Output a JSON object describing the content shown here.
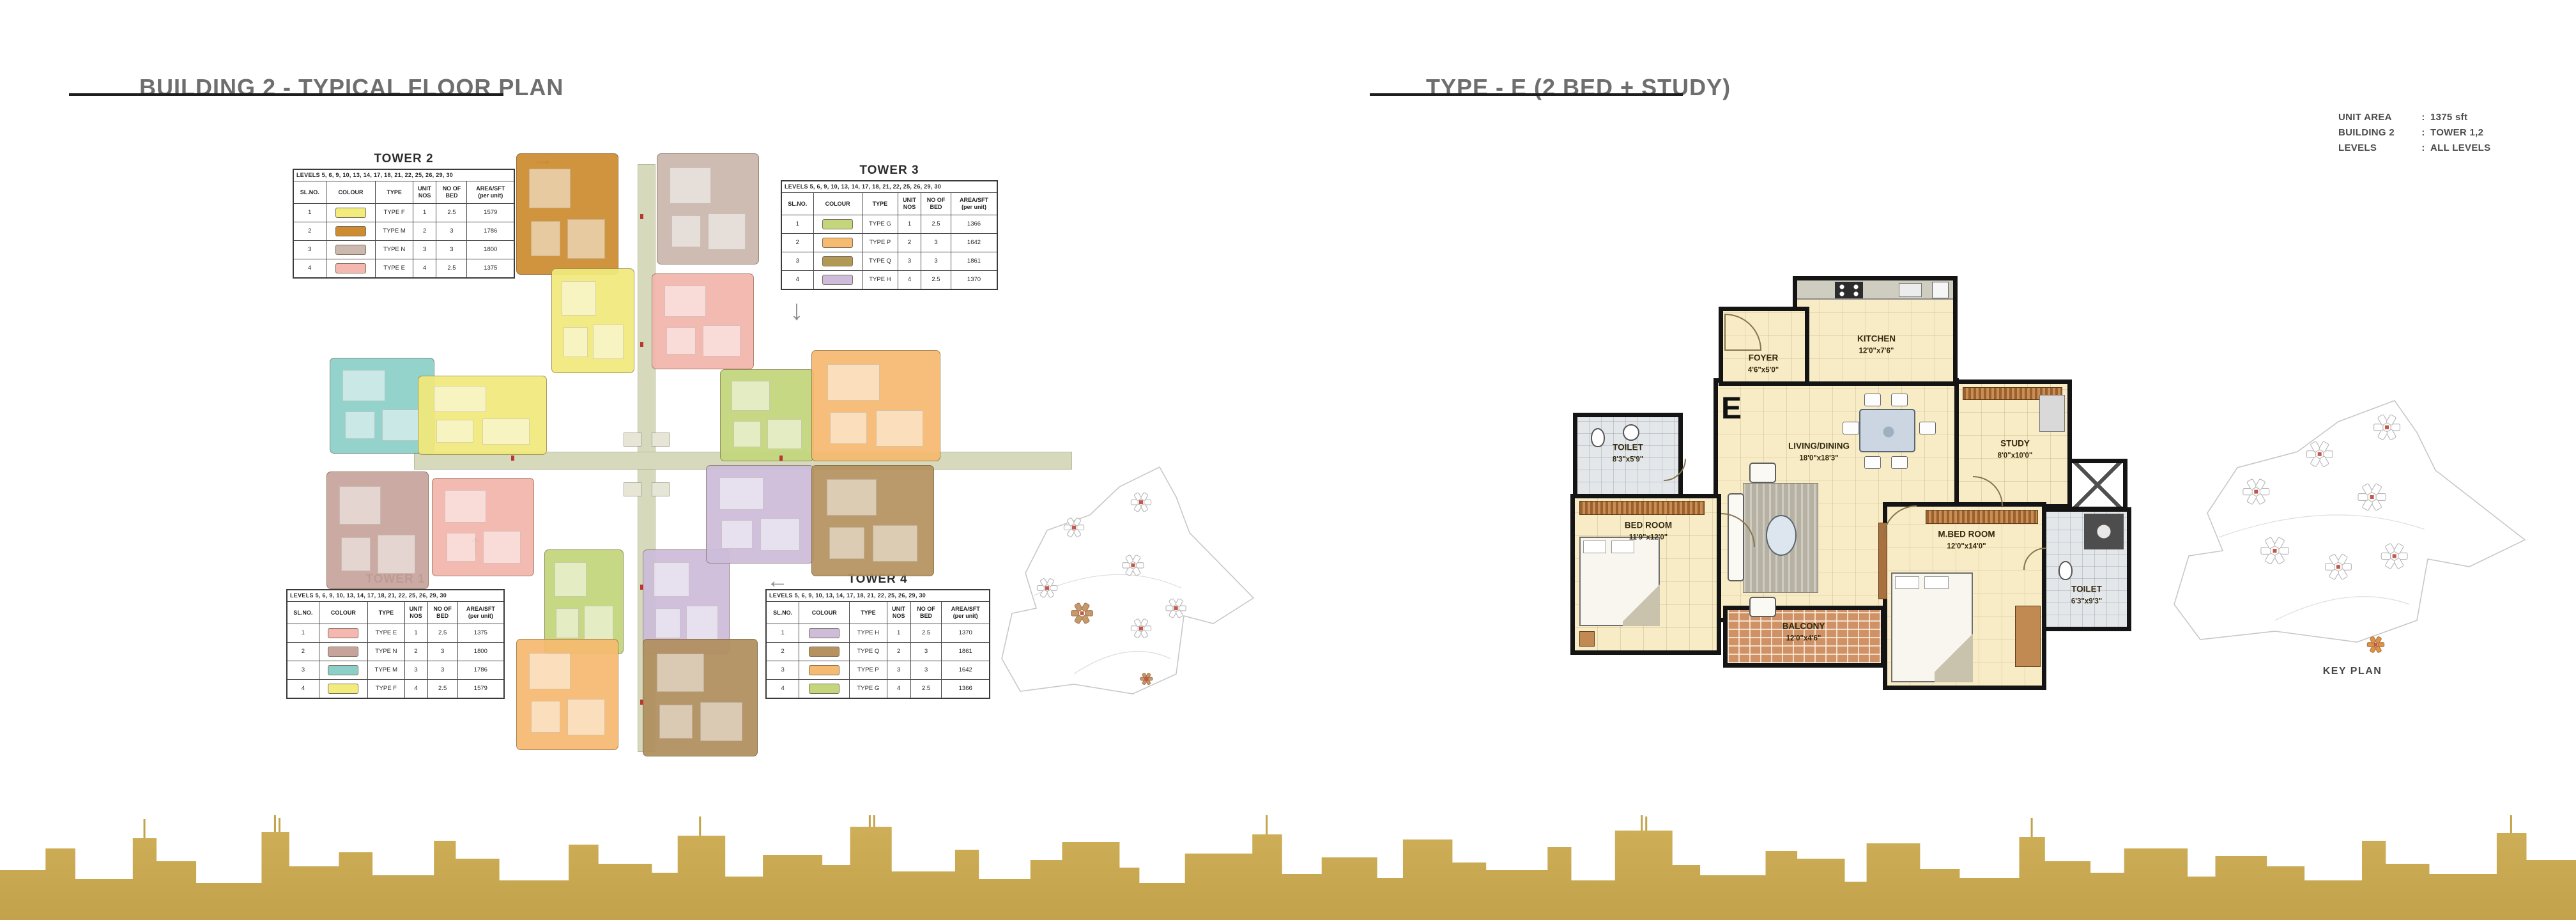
{
  "pages": {
    "left": {
      "title": "BUILDING 2 - TYPICAL FLOOR PLAN"
    },
    "right": {
      "title": "TYPE - E (2 BED + STUDY)"
    }
  },
  "table_headers": [
    "SL.NO.",
    "COLOUR",
    "TYPE",
    "UNIT\nNOS",
    "NO OF\nBED",
    "AREA/SFT\n(per unit)"
  ],
  "levels_line": "LEVELS 5, 6, 9, 10, 13, 14, 17, 18, 21, 22, 25, 26, 29, 30",
  "towers": [
    {
      "name": "TOWER 2",
      "arrow": "right",
      "rows": [
        {
          "sl": "1",
          "color": "#f2ec7d",
          "type": "TYPE F",
          "units": "1",
          "beds": "2.5",
          "area": "1579"
        },
        {
          "sl": "2",
          "color": "#cd8c31",
          "type": "TYPE M",
          "units": "2",
          "beds": "3",
          "area": "1786"
        },
        {
          "sl": "3",
          "color": "#cbb8ae",
          "type": "TYPE N",
          "units": "3",
          "beds": "3",
          "area": "1800"
        },
        {
          "sl": "4",
          "color": "#f4b8b0",
          "type": "TYPE E",
          "units": "4",
          "beds": "2.5",
          "area": "1375"
        }
      ]
    },
    {
      "name": "TOWER 3",
      "arrow": "down",
      "rows": [
        {
          "sl": "1",
          "color": "#c3d67c",
          "type": "TYPE G",
          "units": "1",
          "beds": "2.5",
          "area": "1366"
        },
        {
          "sl": "2",
          "color": "#f6ba70",
          "type": "TYPE P",
          "units": "2",
          "beds": "3",
          "area": "1642"
        },
        {
          "sl": "3",
          "color": "#b09a55",
          "type": "TYPE Q",
          "units": "3",
          "beds": "3",
          "area": "1861"
        },
        {
          "sl": "4",
          "color": "#cdbcda",
          "type": "TYPE H",
          "units": "4",
          "beds": "2.5",
          "area": "1370"
        }
      ]
    },
    {
      "name": "TOWER 1",
      "arrow": "up",
      "rows": [
        {
          "sl": "1",
          "color": "#f4b8b0",
          "type": "TYPE E",
          "units": "1",
          "beds": "2.5",
          "area": "1375"
        },
        {
          "sl": "2",
          "color": "#c7a49b",
          "type": "TYPE N",
          "units": "2",
          "beds": "3",
          "area": "1800"
        },
        {
          "sl": "3",
          "color": "#8ccfc9",
          "type": "TYPE M",
          "units": "3",
          "beds": "3",
          "area": "1786"
        },
        {
          "sl": "4",
          "color": "#f2ec7d",
          "type": "TYPE F",
          "units": "4",
          "beds": "2.5",
          "area": "1579"
        }
      ]
    },
    {
      "name": "TOWER 4",
      "arrow": "left",
      "rows": [
        {
          "sl": "1",
          "color": "#cdbcda",
          "type": "TYPE H",
          "units": "1",
          "beds": "2.5",
          "area": "1370"
        },
        {
          "sl": "2",
          "color": "#b5925f",
          "type": "TYPE Q",
          "units": "2",
          "beds": "3",
          "area": "1861"
        },
        {
          "sl": "3",
          "color": "#f6ba70",
          "type": "TYPE P",
          "units": "3",
          "beds": "3",
          "area": "1642"
        },
        {
          "sl": "4",
          "color": "#c3d67c",
          "type": "TYPE G",
          "units": "4",
          "beds": "2.5",
          "area": "1366"
        }
      ]
    }
  ],
  "unit_info": {
    "rows": [
      {
        "label": "UNIT AREA",
        "value": "1375 sft"
      },
      {
        "label": "BUILDING 2",
        "value": "TOWER 1,2"
      },
      {
        "label": "LEVELS",
        "value": "ALL LEVELS"
      }
    ]
  },
  "floor_plan": {
    "unit_letter": "E",
    "rooms": {
      "kitchen": {
        "name": "KITCHEN",
        "dims": "12'0\"x7'6\""
      },
      "foyer": {
        "name": "FOYER",
        "dims": "4'6\"x5'0\""
      },
      "toilet_left": {
        "name": "TOILET",
        "dims": "8'3\"x5'9\""
      },
      "living_dining": {
        "name": "LIVING/DINING",
        "dims": "18'0\"x18'3\""
      },
      "study": {
        "name": "STUDY",
        "dims": "8'0\"x10'0\""
      },
      "bed_room": {
        "name": "BED ROOM",
        "dims": "11'9\"x12'0\""
      },
      "m_bed_room": {
        "name": "M.BED ROOM",
        "dims": "12'0\"x14'0\""
      },
      "toilet_right": {
        "name": "TOILET",
        "dims": "6'3\"x9'3\""
      },
      "balcony": {
        "name": "BALCONY",
        "dims": "12'0\"x4'6\""
      }
    }
  },
  "key_plan_label": "KEY PLAN",
  "colors": {
    "skyline_gold": "#c3a24c",
    "corridor": "#d6d9bc",
    "plan_floor": "#f8ecc6",
    "wall": "#141414",
    "balcony_tile": "#cf9266",
    "title_gray": "#6e6e6e"
  }
}
